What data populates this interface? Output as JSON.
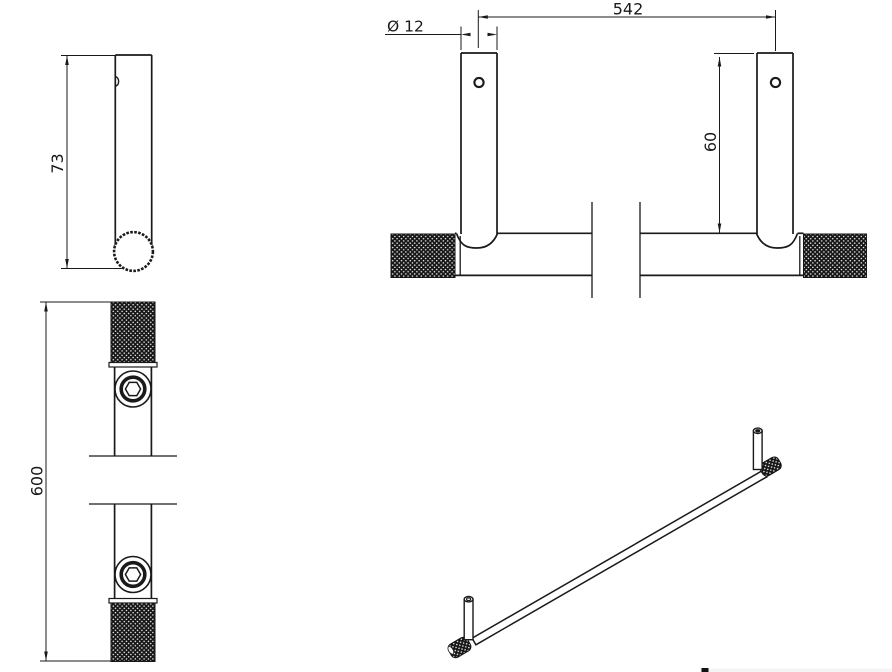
{
  "colors": {
    "background": "#ffffff",
    "line": "#1a1a1a",
    "knurl_fill": "#161616",
    "logo_fragment": "#111111",
    "footer_band": "#f4f4f4"
  },
  "views": {
    "side_view": {
      "label": "post-side-view",
      "height_dim": "73"
    },
    "plan_view": {
      "label": "bar-plan-view",
      "length_dim": "600"
    },
    "front_view": {
      "label": "front-view",
      "span_dim": "542",
      "diameter_dim": "Ø 12",
      "post_height_dim": "60"
    },
    "iso_view": {
      "label": "isometric-view"
    }
  }
}
